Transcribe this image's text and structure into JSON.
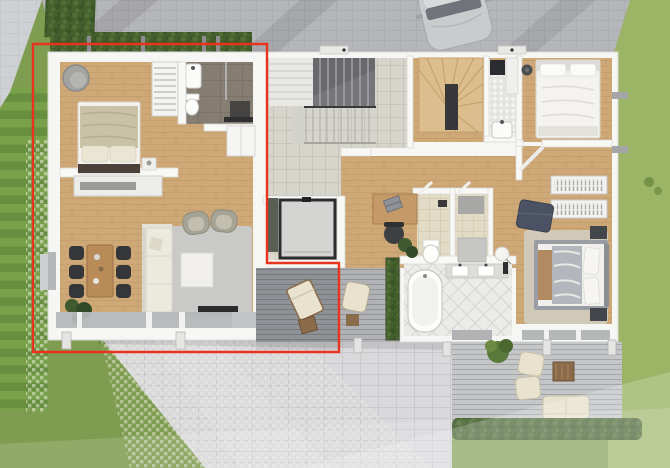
{
  "scene": {
    "type": "architectural-floor-plan-render",
    "view": "top-down-3d",
    "highlight": "left apartment unit outlined in red",
    "outline_color": "#e8341f"
  },
  "palette": {
    "grass": "#7f9d50",
    "grassSide": "#9cb466",
    "lawnStripeA": "#79a14a",
    "lawnStripeB": "#688f3f",
    "paverDriveway": "#b5b6b9",
    "paverPatio": "#d9d9db",
    "paverCorner": "#cfd0d3",
    "wall": "#f6f6f4",
    "woodFloor": "#cfa878",
    "hallTile": "#d7d4cb",
    "beigeTile": "#e2dbc6",
    "whiteTile": "#ebebe7",
    "marble": "#877e73",
    "deckDark": "#8e9195",
    "deckMid": "#b0b2b5",
    "deckLight": "#c4c6c8",
    "hedge": "#44602d",
    "carBody": "#c9cbcd",
    "cream": "#ece9dd",
    "navy": "#4b5263",
    "chairDark": "#35363a",
    "red": "#e8341f"
  },
  "units": {
    "left_apartment": {
      "highlighted": true,
      "rooms": [
        "bedroom",
        "bathroom",
        "hallway",
        "living-dining-room",
        "terrace"
      ],
      "furniture": [
        "double-bed",
        "round-lounge-chair",
        "slatted-cabinet",
        "wardrobe",
        "sideboard",
        "dining-table",
        "six-dining-chairs",
        "corner-sofa",
        "two-armchairs",
        "coffee-table",
        "area-rug",
        "tv-lowboard",
        "houseplants",
        "washbasin",
        "toilet",
        "sun-lounger",
        "side-table"
      ]
    },
    "shared_core": {
      "rooms": [
        "entrance-stairwell",
        "storage-room"
      ],
      "features": [
        "u-shaped-stair",
        "stair-railing",
        "shower-cabin",
        "tall-cabinet"
      ]
    },
    "right_apartment": {
      "highlighted": false,
      "rooms": [
        "entry-hall",
        "winder-staircase",
        "laundry-room",
        "bedroom-top",
        "study-corner",
        "wc",
        "storage",
        "bathroom",
        "bedroom-bottom",
        "terrace"
      ],
      "furniture": [
        "double-bed-top",
        "double-bed-bottom",
        "desk",
        "office-chair",
        "laptop",
        "toilet",
        "bathtub",
        "double-washbasin",
        "wardrobe-racks",
        "ottoman",
        "floor-lamp",
        "nightstands",
        "area-rug",
        "outdoor-armchair"
      ]
    }
  },
  "outdoor": {
    "elements": [
      "driveway",
      "parked-car",
      "boxwood-hedge",
      "striped-lawn",
      "grass-paver-strip",
      "stone-patio",
      "wooden-deck-left",
      "wooden-deck-right",
      "planter",
      "garden-hedge",
      "lawn"
    ],
    "terrace_furniture": [
      "outdoor-armchairs",
      "outdoor-sofa",
      "outdoor-coffee-table",
      "shrub",
      "sun-lounger",
      "side-table"
    ]
  }
}
